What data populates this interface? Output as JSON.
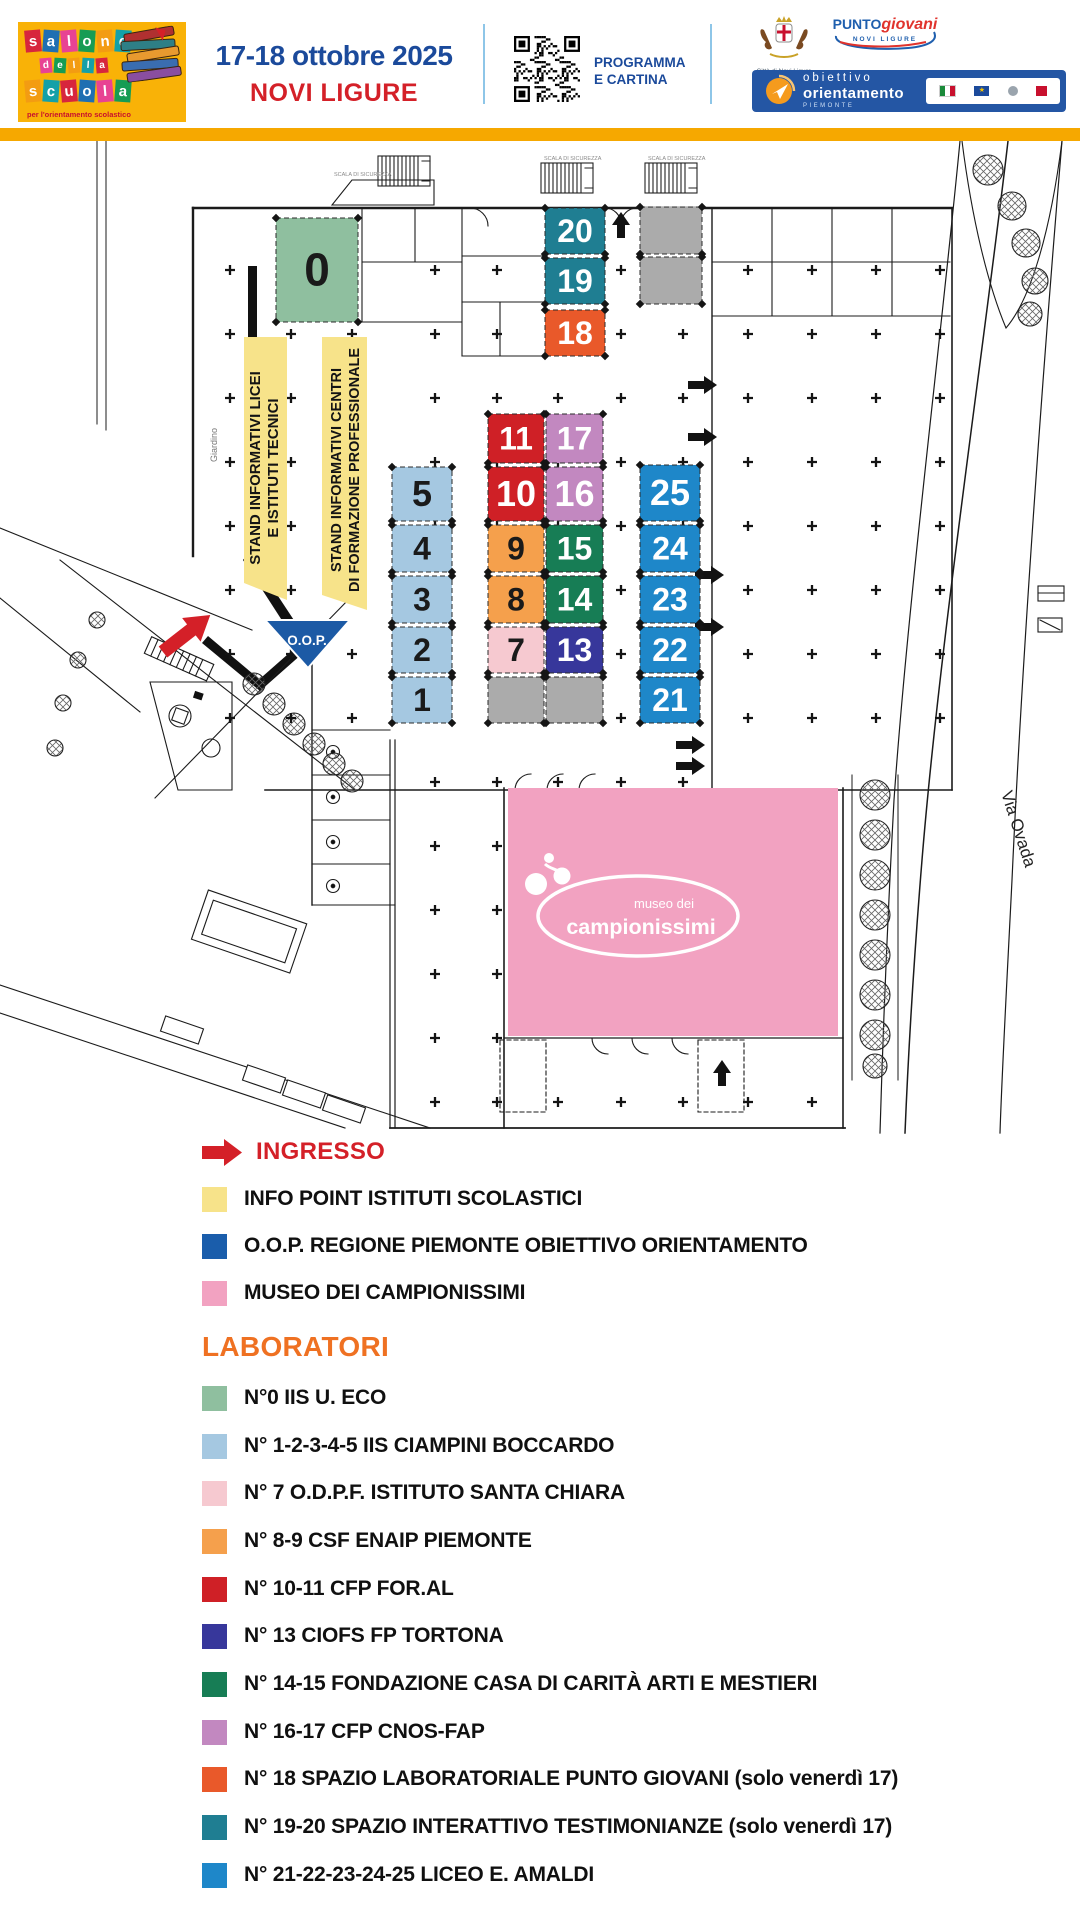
{
  "header": {
    "logo": {
      "line1": "salone",
      "line2": "della",
      "line3": "scuola",
      "tagline": "per l'orientamento scolastico"
    },
    "date": "17-18 ottobre 2025",
    "city": "NOVI LIGURE",
    "qr": {
      "line1": "PROGRAMMA",
      "line2": "E CARTINA"
    },
    "coat_caption": "Città di Novi Ligure",
    "punto": {
      "part1": "PUNTO",
      "part2": "giovani",
      "sub": "NOVI LIGURE"
    },
    "orient": {
      "word1": "obiettivo",
      "word2": "orientamento",
      "region": "PIEMONTE"
    }
  },
  "plan": {
    "labels": {
      "band1_line1": "STAND INFORMATIVI LICEI",
      "band1_line2": "E ISTITUTI TECNICI",
      "band2_line1": "STAND INFORMATIVI CENTRI",
      "band2_line2": "DI FORMAZIONE PROFESSIONALE",
      "oop": "O.O.P.",
      "giardino": "Giardino",
      "via_ovada": "Via Ovada",
      "museo_line1": "museo dei",
      "museo_line2": "campionissimi",
      "scala": "SCALA DI SICUREZZA"
    },
    "colors": {
      "yellow_band": "#f7e38a",
      "sage": "#8fbf9f",
      "teal": "#1f7e92",
      "orange_red": "#e9592a",
      "gray": "#ababab",
      "red": "#cf2026",
      "purple": "#c288c0",
      "orange": "#f5a04c",
      "green": "#177d55",
      "light_blue": "#a5c8e1",
      "light_pink": "#f6c9d0",
      "navy": "#37379b",
      "blue": "#1e87c9",
      "museum_pink": "#f2a2c1",
      "oop_blue": "#1c5aa5",
      "entrance_red": "#d42028"
    },
    "stands": [
      {
        "label": "0",
        "x": 276,
        "y": 218,
        "w": 82,
        "h": 104,
        "color": "#8fbf9f",
        "text_color": "#1a1a1a",
        "fs": 46
      },
      {
        "label": "20",
        "x": 545,
        "y": 208,
        "w": 60,
        "h": 46,
        "color": "#1f7e92",
        "text_color": "#fff"
      },
      {
        "label": "19",
        "x": 545,
        "y": 258,
        "w": 60,
        "h": 46,
        "color": "#1f7e92",
        "text_color": "#fff"
      },
      {
        "label": "18",
        "x": 545,
        "y": 310,
        "w": 60,
        "h": 46,
        "color": "#e9592a",
        "text_color": "#fff"
      },
      {
        "label": "",
        "x": 640,
        "y": 207,
        "w": 62,
        "h": 47,
        "color": "#ababab"
      },
      {
        "label": "",
        "x": 640,
        "y": 257,
        "w": 62,
        "h": 47,
        "color": "#ababab"
      },
      {
        "label": "11",
        "x": 488,
        "y": 414,
        "w": 56,
        "h": 49,
        "color": "#cf2026",
        "text_color": "#fff"
      },
      {
        "label": "17",
        "x": 546,
        "y": 414,
        "w": 57,
        "h": 49,
        "color": "#c288c0",
        "text_color": "#fff"
      },
      {
        "label": "10",
        "x": 488,
        "y": 467,
        "w": 56,
        "h": 54,
        "color": "#cf2026",
        "text_color": "#fff"
      },
      {
        "label": "16",
        "x": 546,
        "y": 467,
        "w": 57,
        "h": 54,
        "color": "#c288c0",
        "text_color": "#fff"
      },
      {
        "label": "9",
        "x": 488,
        "y": 525,
        "w": 56,
        "h": 47,
        "color": "#f5a04c",
        "text_color": "#1a1a1a"
      },
      {
        "label": "15",
        "x": 546,
        "y": 525,
        "w": 57,
        "h": 47,
        "color": "#177d55",
        "text_color": "#fff"
      },
      {
        "label": "8",
        "x": 488,
        "y": 576,
        "w": 56,
        "h": 47,
        "color": "#f5a04c",
        "text_color": "#1a1a1a"
      },
      {
        "label": "14",
        "x": 546,
        "y": 576,
        "w": 57,
        "h": 47,
        "color": "#177d55",
        "text_color": "#fff"
      },
      {
        "label": "7",
        "x": 488,
        "y": 627,
        "w": 56,
        "h": 46,
        "color": "#f6c9d0",
        "text_color": "#1a1a1a"
      },
      {
        "label": "13",
        "x": 546,
        "y": 627,
        "w": 57,
        "h": 46,
        "color": "#37379b",
        "text_color": "#fff"
      },
      {
        "label": "5",
        "x": 392,
        "y": 467,
        "w": 60,
        "h": 54,
        "color": "#a5c8e1",
        "text_color": "#1a1a1a"
      },
      {
        "label": "4",
        "x": 392,
        "y": 525,
        "w": 60,
        "h": 47,
        "color": "#a5c8e1",
        "text_color": "#1a1a1a"
      },
      {
        "label": "3",
        "x": 392,
        "y": 576,
        "w": 60,
        "h": 47,
        "color": "#a5c8e1",
        "text_color": "#1a1a1a"
      },
      {
        "label": "2",
        "x": 392,
        "y": 627,
        "w": 60,
        "h": 46,
        "color": "#a5c8e1",
        "text_color": "#1a1a1a"
      },
      {
        "label": "1",
        "x": 392,
        "y": 677,
        "w": 60,
        "h": 46,
        "color": "#a5c8e1",
        "text_color": "#1a1a1a"
      },
      {
        "label": "",
        "x": 488,
        "y": 677,
        "w": 56,
        "h": 46,
        "color": "#ababab"
      },
      {
        "label": "",
        "x": 546,
        "y": 677,
        "w": 57,
        "h": 46,
        "color": "#ababab"
      },
      {
        "label": "25",
        "x": 640,
        "y": 465,
        "w": 60,
        "h": 56,
        "color": "#1e87c9",
        "text_color": "#fff"
      },
      {
        "label": "24",
        "x": 640,
        "y": 525,
        "w": 60,
        "h": 47,
        "color": "#1e87c9",
        "text_color": "#fff"
      },
      {
        "label": "23",
        "x": 640,
        "y": 576,
        "w": 60,
        "h": 47,
        "color": "#1e87c9",
        "text_color": "#fff"
      },
      {
        "label": "22",
        "x": 640,
        "y": 627,
        "w": 60,
        "h": 46,
        "color": "#1e87c9",
        "text_color": "#fff"
      },
      {
        "label": "21",
        "x": 640,
        "y": 677,
        "w": 60,
        "h": 46,
        "color": "#1e87c9",
        "text_color": "#fff"
      }
    ]
  },
  "legend": {
    "ingresso_label": "INGRESSO",
    "items": [
      {
        "color": "#f7e38a",
        "label": "INFO POINT ISTITUTI SCOLASTICI"
      },
      {
        "color": "#1a5dab",
        "label": "O.O.P. REGIONE PIEMONTE OBIETTIVO ORIENTAMENTO"
      },
      {
        "color": "#f2a2c1",
        "label": "MUSEO DEI CAMPIONISSIMI"
      }
    ],
    "laboratori_title": "LABORATORI",
    "labs": [
      {
        "color": "#8fbf9f",
        "label": "N°0 IIS U. ECO"
      },
      {
        "color": "#a5c8e1",
        "label": "N° 1-2-3-4-5 IIS CIAMPINI BOCCARDO"
      },
      {
        "color": "#f6c9d0",
        "label": "N° 7 O.D.P.F. ISTITUTO SANTA CHIARA"
      },
      {
        "color": "#f5a04c",
        "label": "N° 8-9 CSF ENAIP PIEMONTE"
      },
      {
        "color": "#cf2026",
        "label": "N° 10-11 CFP FOR.AL"
      },
      {
        "color": "#37379b",
        "label": "N° 13 CIOFS FP TORTONA"
      },
      {
        "color": "#177d55",
        "label": "N° 14-15 FONDAZIONE CASA DI CARITÀ ARTI E MESTIERI"
      },
      {
        "color": "#c288c0",
        "label": "N° 16-17 CFP CNOS-FAP"
      },
      {
        "color": "#e9592a",
        "label": "N° 18 SPAZIO LABORATORIALE PUNTO GIOVANI (solo venerdì 17)"
      },
      {
        "color": "#1f7e92",
        "label": "N° 19-20 SPAZIO INTERATTIVO TESTIMONIANZE (solo venerdì 17)"
      },
      {
        "color": "#1e87c9",
        "label": "N° 21-22-23-24-25 LICEO E. AMALDI"
      }
    ]
  }
}
